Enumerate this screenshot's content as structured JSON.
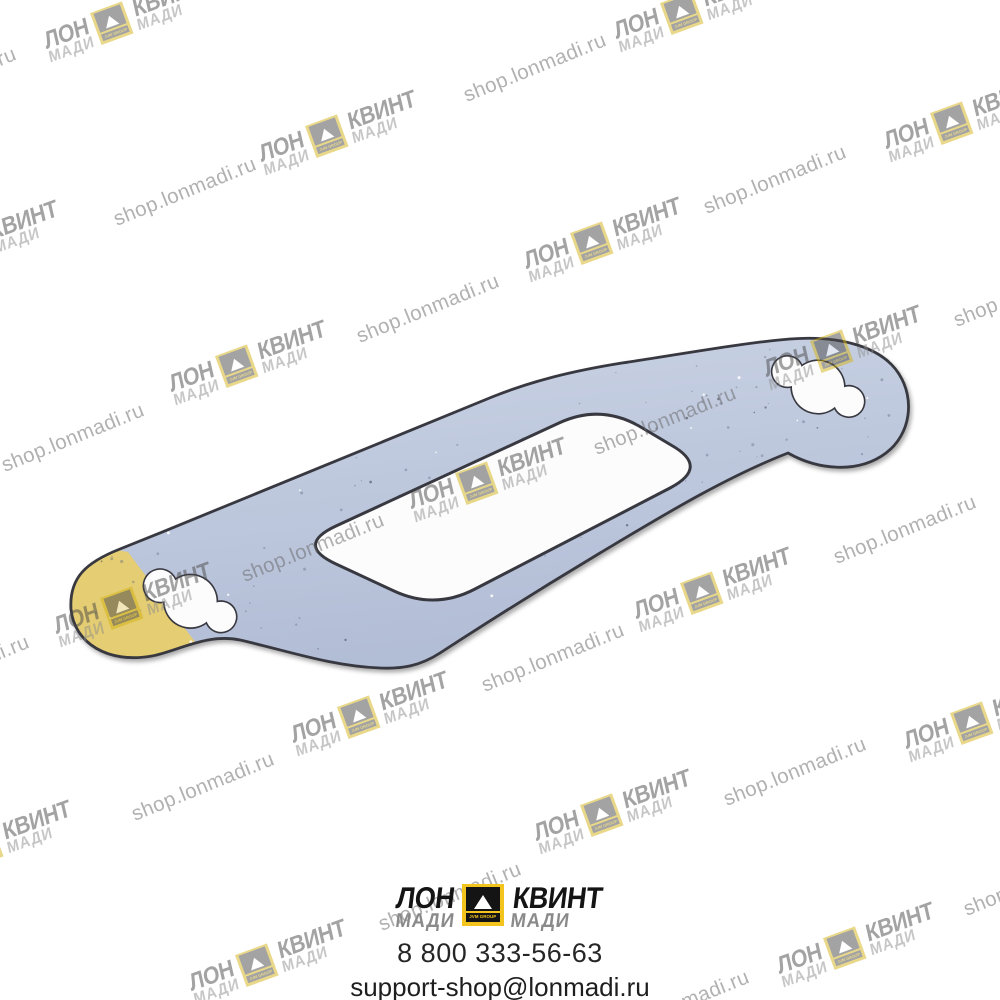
{
  "canvas": {
    "width": 1000,
    "height": 1000,
    "background": "#ffffff"
  },
  "watermark": {
    "text": "shop.lonmadi.ru",
    "text_angle_deg": -22,
    "logo_angle_deg": -20,
    "layer_opacity": 0.5,
    "text_color": "#656565",
    "logo_dark_color": "#4a4a4a",
    "logo_madi_color": "#8f8f8f",
    "logo_yellow_color": "#d4b315",
    "text_positions": [
      [
        -55,
        82
      ],
      [
        535,
        68
      ],
      [
        185,
        192
      ],
      [
        775,
        180
      ],
      [
        1025,
        293
      ],
      [
        428,
        309
      ],
      [
        73,
        438
      ],
      [
        665,
        421
      ],
      [
        313,
        548
      ],
      [
        905,
        530
      ],
      [
        553,
        658
      ],
      [
        -42,
        670
      ],
      [
        203,
        787
      ],
      [
        795,
        772
      ],
      [
        450,
        897
      ],
      [
        1035,
        882
      ],
      [
        678,
        1005
      ]
    ],
    "logo_positions": [
      [
        125,
        20
      ],
      [
        695,
        10
      ],
      [
        340,
        133
      ],
      [
        965,
        120
      ],
      [
        -18,
        243
      ],
      [
        605,
        240
      ],
      [
        250,
        363
      ],
      [
        845,
        348
      ],
      [
        490,
        480
      ],
      [
        135,
        605
      ],
      [
        715,
        590
      ],
      [
        372,
        714
      ],
      [
        985,
        720
      ],
      [
        -5,
        843
      ],
      [
        615,
        812
      ],
      [
        270,
        962
      ],
      [
        858,
        945
      ]
    ]
  },
  "brand_logo": {
    "word_left": "ЛОН",
    "word_right": "КВИНТ",
    "sub_left": "МАДИ",
    "sub_right": "МАДИ",
    "icon_label": "JVM GROUP"
  },
  "footer": {
    "phone": "8 800 333-56-63",
    "email": "support-shop@lonmadi.ru",
    "phone_color": "#262626",
    "email_color": "#1e1e1e",
    "logo_black_color": "#141414",
    "logo_gray_color": "#8a8a8a",
    "logo_yellow_color": "#f2c41d"
  },
  "gasket": {
    "description": "exhaust manifold gasket, blue-gray with yellow coated tip, two scalloped bolt slots and large center port",
    "body_color_light": "#cad3e4",
    "body_color": "#b2bdd6",
    "edge_color": "#383840",
    "patch_color": "#e4cd72",
    "hole_fill": "#fcfcfd",
    "speckle_color": "#5a6480"
  }
}
